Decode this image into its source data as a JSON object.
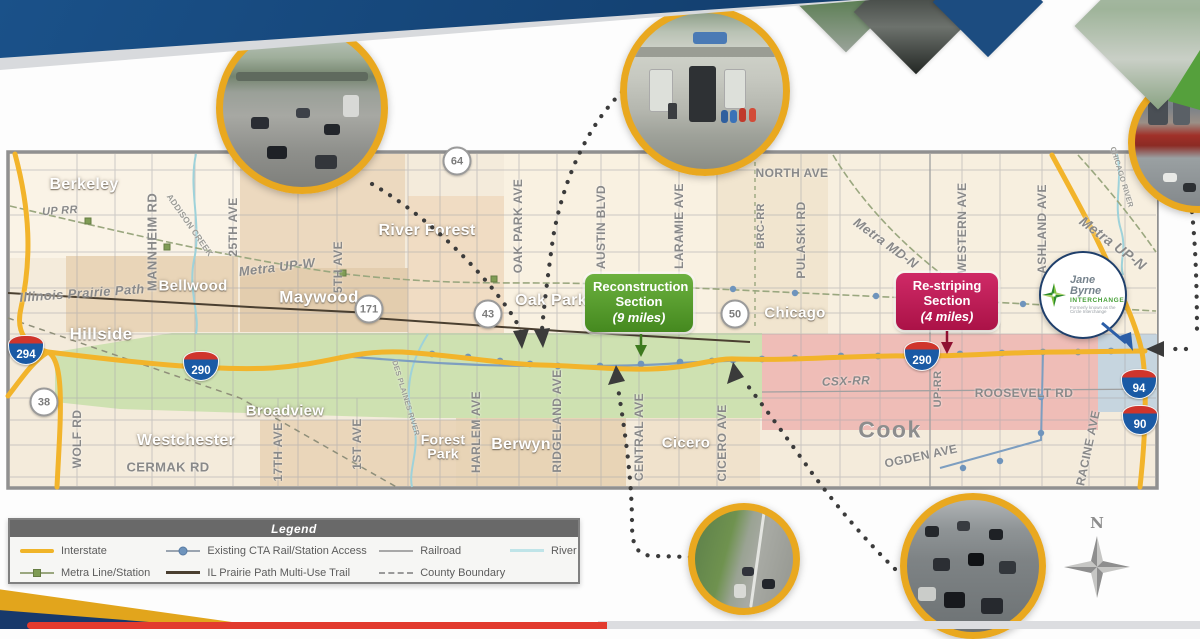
{
  "map": {
    "cities": [
      {
        "t": "Berkeley",
        "x": 84,
        "y": 185,
        "s": 16
      },
      {
        "t": "Bellwood",
        "x": 193,
        "y": 286,
        "s": 15
      },
      {
        "t": "Maywood",
        "x": 319,
        "y": 297,
        "s": 17
      },
      {
        "t": "Hillside",
        "x": 101,
        "y": 334,
        "s": 17
      },
      {
        "t": "River Forest",
        "x": 427,
        "y": 231,
        "s": 16
      },
      {
        "t": "Oak Park",
        "x": 551,
        "y": 301,
        "s": 16
      },
      {
        "t": "Broadview",
        "x": 285,
        "y": 411,
        "s": 15
      },
      {
        "t": "Westchester",
        "x": 186,
        "y": 441,
        "s": 16
      },
      {
        "t": "Forest\nPark",
        "x": 443,
        "y": 447,
        "s": 14
      },
      {
        "t": "Berwyn",
        "x": 521,
        "y": 445,
        "s": 16
      },
      {
        "t": "Cicero",
        "x": 686,
        "y": 443,
        "s": 15
      },
      {
        "t": "Chicago",
        "x": 795,
        "y": 313,
        "s": 15
      },
      {
        "t": "Cook",
        "x": 890,
        "y": 430,
        "s": 23,
        "k": "county"
      }
    ],
    "roads": [
      {
        "t": "UP RR",
        "x": 60,
        "y": 211,
        "s": 11,
        "r": -4,
        "k": "it"
      },
      {
        "t": "MANNHEIM RD",
        "x": 152,
        "y": 242,
        "s": 13,
        "r": -90
      },
      {
        "t": "ADDISON CREEK",
        "x": 190,
        "y": 225,
        "s": 8.5,
        "r": 55,
        "k": "riv"
      },
      {
        "t": "25TH AVE",
        "x": 233,
        "y": 227,
        "s": 12,
        "r": -90
      },
      {
        "t": "5TH AVE",
        "x": 338,
        "y": 267,
        "s": 12,
        "r": -90
      },
      {
        "t": "Metra UP-W",
        "x": 277,
        "y": 267,
        "s": 13,
        "r": -7,
        "k": "it"
      },
      {
        "t": "Illinois Prairie Path",
        "x": 82,
        "y": 293,
        "s": 13,
        "r": -4,
        "k": "it"
      },
      {
        "t": "WOLF RD",
        "x": 77,
        "y": 439,
        "s": 12,
        "r": -90
      },
      {
        "t": "CERMAK RD",
        "x": 168,
        "y": 467,
        "s": 13,
        "r": 0
      },
      {
        "t": "17TH AVE",
        "x": 278,
        "y": 452,
        "s": 12,
        "r": -90
      },
      {
        "t": "1ST AVE",
        "x": 357,
        "y": 444,
        "s": 12,
        "r": -90
      },
      {
        "t": "DES PLAINES RIVER",
        "x": 406,
        "y": 398,
        "s": 7.5,
        "r": 73,
        "k": "riv"
      },
      {
        "t": "HARLEM AVE",
        "x": 476,
        "y": 432,
        "s": 12,
        "r": -90
      },
      {
        "t": "RIDGELAND AVE",
        "x": 557,
        "y": 421,
        "s": 12,
        "r": -90
      },
      {
        "t": "OAK PARK AVE",
        "x": 518,
        "y": 226,
        "s": 12,
        "r": -90
      },
      {
        "t": "AUSTIN BLVD",
        "x": 601,
        "y": 227,
        "s": 12,
        "r": -90
      },
      {
        "t": "LARAMIE AVE",
        "x": 679,
        "y": 226,
        "s": 12,
        "r": -90
      },
      {
        "t": "CENTRAL AVE",
        "x": 639,
        "y": 437,
        "s": 12,
        "r": -90
      },
      {
        "t": "CICERO AVE",
        "x": 722,
        "y": 443,
        "s": 12,
        "r": -90
      },
      {
        "t": "NORTH AVE",
        "x": 792,
        "y": 173,
        "s": 12,
        "r": 0
      },
      {
        "t": "BRC-RR",
        "x": 761,
        "y": 226,
        "s": 11,
        "r": -90
      },
      {
        "t": "PULASKI RD",
        "x": 801,
        "y": 240,
        "s": 12,
        "r": -90
      },
      {
        "t": "Metra MD-N",
        "x": 886,
        "y": 243,
        "s": 13,
        "r": 36,
        "k": "it"
      },
      {
        "t": "WESTERN AVE",
        "x": 962,
        "y": 228,
        "s": 12,
        "r": -90
      },
      {
        "t": "CSX-RR",
        "x": 846,
        "y": 381,
        "s": 12,
        "r": -2,
        "k": "it"
      },
      {
        "t": "UP-RR",
        "x": 938,
        "y": 389,
        "s": 11,
        "r": -90
      },
      {
        "t": "ROOSEVELT RD",
        "x": 1024,
        "y": 393,
        "s": 12,
        "r": 0
      },
      {
        "t": "OGDEN AVE",
        "x": 921,
        "y": 456,
        "s": 12,
        "r": -12
      },
      {
        "t": "RACINE AVE",
        "x": 1088,
        "y": 448,
        "s": 12,
        "r": -78
      },
      {
        "t": "ASHLAND AVE",
        "x": 1042,
        "y": 229,
        "s": 12,
        "r": -90
      },
      {
        "t": "CHICAGO RIVER",
        "x": 1122,
        "y": 177,
        "s": 7.5,
        "r": 73,
        "k": "riv"
      },
      {
        "t": "Metra UP-N",
        "x": 1113,
        "y": 243,
        "s": 14,
        "r": 37,
        "k": "it"
      }
    ],
    "interstate_shields": [
      {
        "n": "294",
        "x": 26,
        "y": 350
      },
      {
        "n": "290",
        "x": 201,
        "y": 366
      },
      {
        "n": "290",
        "x": 922,
        "y": 356
      },
      {
        "n": "94",
        "x": 1139,
        "y": 384
      },
      {
        "n": "90",
        "x": 1140,
        "y": 420
      }
    ],
    "route_shields": [
      {
        "n": "64",
        "x": 457,
        "y": 161
      },
      {
        "n": "171",
        "x": 369,
        "y": 309
      },
      {
        "n": "43",
        "x": 488,
        "y": 314
      },
      {
        "n": "50",
        "x": 735,
        "y": 314
      },
      {
        "n": "38",
        "x": 44,
        "y": 402
      }
    ]
  },
  "callouts": {
    "reconstruction": {
      "lines": [
        "Reconstruction",
        "Section",
        "(9 miles)"
      ]
    },
    "restriping": {
      "lines": [
        "Re-striping",
        "Section",
        "(4 miles)"
      ]
    }
  },
  "jane_byrne": {
    "title": "Jane Byrne",
    "subtitle": "INTERCHANGE",
    "tagline": "Formerly known as the Circle Interchange"
  },
  "legend": {
    "title": "Legend",
    "items": [
      {
        "label": "Interstate",
        "swatch": "interstate",
        "col": 0
      },
      {
        "label": "Metra Line/Station",
        "swatch": "metra",
        "col": 0
      },
      {
        "label": "Existing CTA Rail/Station Access",
        "swatch": "cta",
        "col": 1
      },
      {
        "label": "IL Prairie Path Multi-Use Trail",
        "swatch": "trail",
        "col": 1
      },
      {
        "label": "Railroad",
        "swatch": "railroad",
        "col": 2
      },
      {
        "label": "County Boundary",
        "swatch": "county",
        "col": 2
      },
      {
        "label": "River",
        "swatch": "river",
        "col": 3
      }
    ]
  },
  "compass": {
    "label": "N"
  },
  "colors": {
    "accent_gold": "#E9A81F",
    "navy": "#16497E",
    "reconstruction_green": "#4E9E2F",
    "restriping_magenta": "#C41F5B",
    "interstate_yellow": "#F2B42B",
    "corridor_green": "#CEE1B1",
    "restriping_pink": "#EEB9B4"
  }
}
